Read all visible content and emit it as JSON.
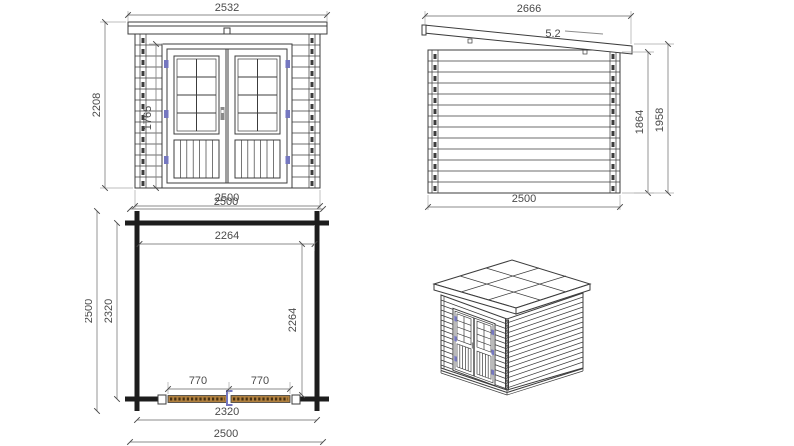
{
  "page": {
    "title": "Garden shed technical drawing"
  },
  "views": {
    "front": {
      "name": "front-elevation",
      "dims": {
        "top_width": "2532",
        "left_height": "2208",
        "door_height": "1765",
        "bottom_width": "2500"
      }
    },
    "side": {
      "name": "side-elevation",
      "dims": {
        "top_width": "2666",
        "roof_pitch": "5.2",
        "wall_height": "1864",
        "total_height": "1958",
        "bottom_width": "2500"
      }
    },
    "plan": {
      "name": "floor-plan",
      "dims": {
        "outer_width_top": "2500",
        "inner_width_top": "2264",
        "outer_depth_left": "2500",
        "wall_depth_left": "2320",
        "inner_depth_right": "2264",
        "door_leaf_left": "770",
        "door_leaf_right": "770",
        "wall_width_bottom": "2320",
        "outer_width_bottom": "2500"
      }
    },
    "iso": {
      "name": "isometric-view"
    }
  },
  "colors": {
    "line": "#3c3c3c",
    "dimension_text": "#4a4a4a",
    "hinge_accent": "#7577c0",
    "door_wood": "#b0803f",
    "door_wood_dark": "#473012",
    "background": "#ffffff"
  }
}
